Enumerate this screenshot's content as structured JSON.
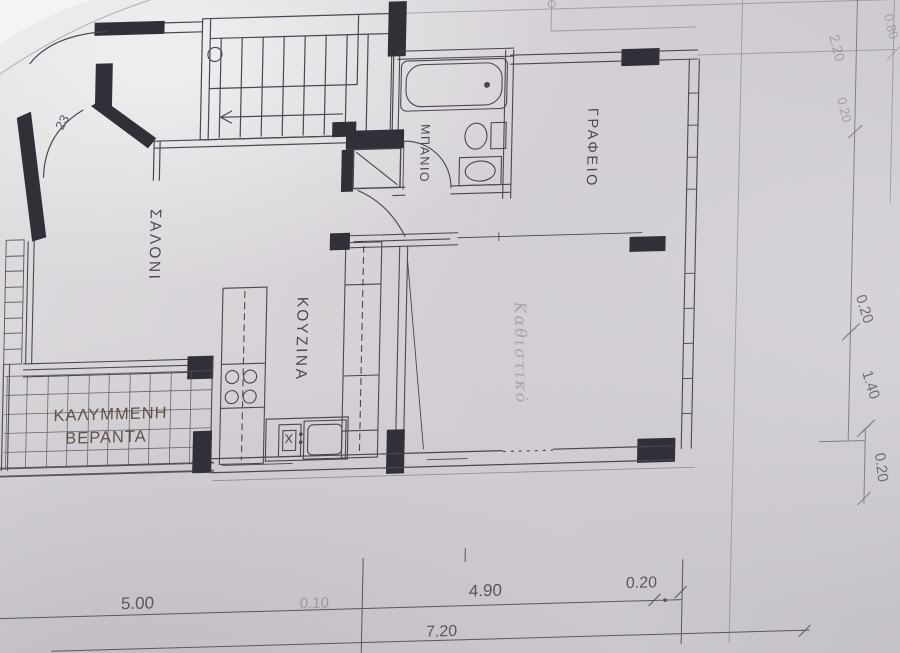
{
  "rooms": {
    "salon": "ΣΑΛΟΝΙ",
    "kitchen": "ΚΟΥΖΙΝΑ",
    "bathroom": "ΜΠΑΝΙΟ",
    "office": "ΓΡΑΦΕΙΟ",
    "veranda_line1": "ΚΑΛΥΜΜΕΝΗ",
    "veranda_line2": "ΒΕΡΑΝΤΑ",
    "living_handwritten": "Καθιστικό"
  },
  "annotations": {
    "door_number": "23"
  },
  "dimensions": {
    "bottom_left": "5.00",
    "bottom_mid_faint": "0.10",
    "bottom_right": "4.90",
    "bottom_small": "0.20",
    "bottom_total": "7.20",
    "right_upper_a": "0.80",
    "right_upper_b": "2.20",
    "right_upper_c": "0.20",
    "right_mid_a": "0.20",
    "right_mid_b": "1.40",
    "right_corner": "0.20"
  }
}
